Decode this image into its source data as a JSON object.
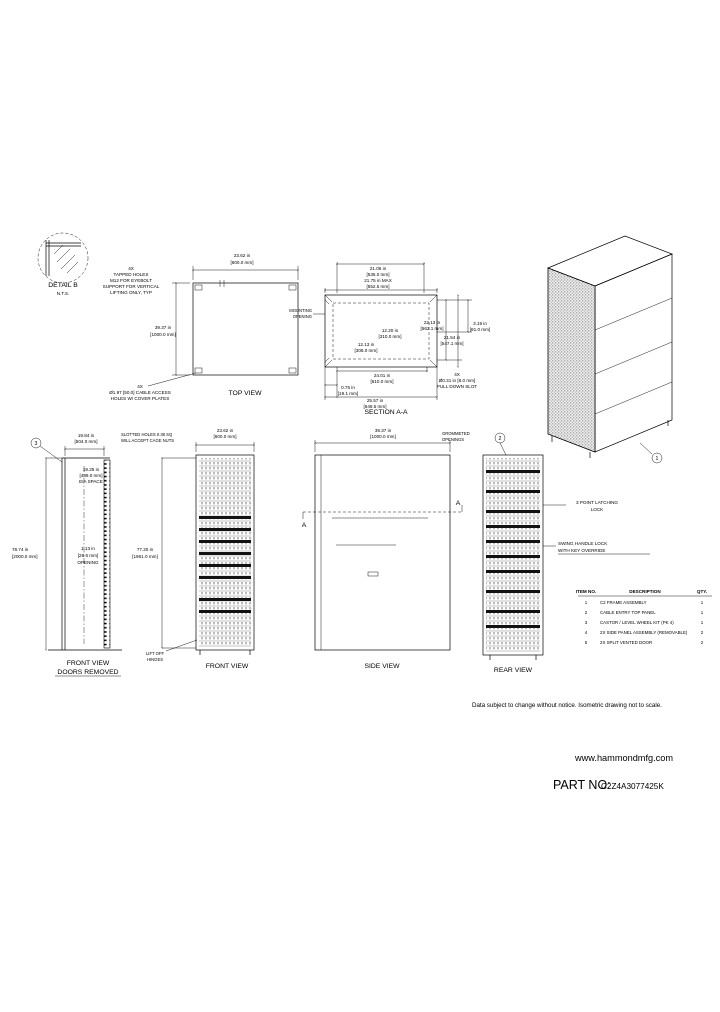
{
  "colors": {
    "line": "#000000",
    "background": "#ffffff"
  },
  "drawing": {
    "detail": {
      "title": "DETAIL B",
      "scale": "N.T.S."
    },
    "lift_note": [
      "4X",
      "TAPPED HOLES",
      "M12 FOR EYEBOLT",
      "SUPPORT FOR VERTICAL",
      "LIFTING ONLY, TYP"
    ],
    "top_view": {
      "label": "TOP VIEW",
      "width_in": "23.62 in",
      "width_mm": "[600.0 mm]",
      "depth_in": "39.37 in",
      "depth_mm": "[1000.0 mm]",
      "cable_note": [
        "4X",
        "Ø1.97 [50.0] CABLE ACCESS",
        "HOLES W/ COVER PLATES"
      ]
    },
    "section": {
      "label": "SECTION A-A",
      "mounting_note": [
        "MOUNTING",
        "OPENING"
      ],
      "top_in": "21.06 in",
      "top_mm": "[535.0 mm]",
      "top_max_in": "21.75 in MAX",
      "top_max_mm": "[552.5 mm]",
      "center1_in": "12.20 in",
      "center1_mm": "[310.0 mm]",
      "center2_in": "12.13 in",
      "center2_mm": "[308.0 mm]",
      "right1_in": "22.13 in",
      "right1_mm": "[562.1 mm]",
      "right2_in": "21.54 in",
      "right2_mm": "[547.1 mm]",
      "right3_in": "3.19 in",
      "right3_mm": "[81.0 mm]",
      "bottom1_in": "24.01 in",
      "bottom1_mm": "[610.0 mm]",
      "bottom2_in": "0.75 in",
      "bottom2_mm": "[19.1 mm]",
      "bottom3_in": "25.57 in",
      "bottom3_mm": "[649.5 mm]",
      "slot_note": [
        "4X",
        "Ø0.31 in [8.0 mm]",
        "PULL DOWN SLOT"
      ]
    },
    "front_open": {
      "balloon": "3",
      "label_line1": "FRONT VIEW",
      "label_line2": "DOORS REMOVED",
      "top_in": "19.84 in",
      "top_mm": "[504.0 mm]",
      "cage_note": [
        "SLOTTED HOLES 0.38 SQ",
        "WILL ACCEPT CAGE NUTS"
      ],
      "eia_note": [
        "19.25 in",
        "[489.0 mm]",
        "EIA SPACE"
      ],
      "height_in": "78.74 in",
      "height_mm": "[2000.0 mm]",
      "opening_note": [
        "1.13 in",
        "[28.6 mm]",
        "OPENING"
      ]
    },
    "front": {
      "label": "FRONT VIEW",
      "width_in": "23.62 in",
      "width_mm": "[600.0 mm]",
      "height_in": "77.20 in",
      "height_mm": "[1961.0 mm]",
      "hinge_note": [
        "LIFT OFF",
        "HINGES"
      ]
    },
    "side": {
      "label": "SIDE VIEW",
      "depth_in": "39.37 in",
      "depth_mm": "[1000.0 mm]",
      "section_marker": "A"
    },
    "rear": {
      "label": "REAR VIEW",
      "balloon": "2",
      "grommet_note": [
        "GROMMETED",
        "OPENINGS"
      ],
      "latch_note": [
        "3 POINT LATCHING",
        "LOCK"
      ],
      "handle_note": [
        "SWING HANDLE LOCK",
        "WITH KEY OVERRIDE"
      ]
    },
    "iso": {
      "balloon": "1"
    }
  },
  "bom": {
    "headers": [
      "ITEM NO.",
      "DESCRIPTION",
      "QTY."
    ],
    "rows": [
      [
        "1",
        "C2 FRAME ASSEMBLY",
        "1"
      ],
      [
        "2",
        "CABLE ENTRY TOP PANEL",
        "1"
      ],
      [
        "3",
        "CASTOR / LEVEL WHEEL KIT (PK 4)",
        "1"
      ],
      [
        "4",
        "2X SIDE PANEL ASSEMBLY (REMOVABLE)",
        "2"
      ],
      [
        "5",
        "2X SPLIT VENTED DOOR",
        "2"
      ]
    ]
  },
  "footer": {
    "note": "Data subject to change without notice. Isometric drawing not to scale.",
    "website": "www.hammondmfg.com",
    "part_label": "PART NO:",
    "part_number": "C2Z4A3077425K"
  }
}
